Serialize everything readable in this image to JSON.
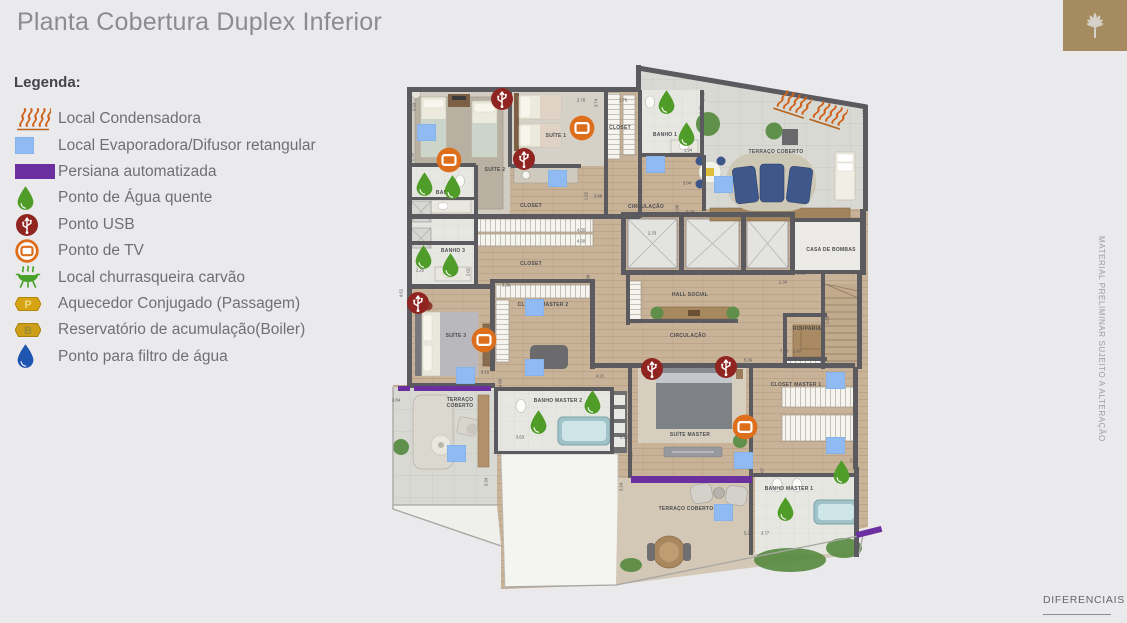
{
  "page": {
    "title": "Planta Cobertura Duplex Inferior",
    "watermark": "MATERIAL PRELIMINAR SUJEITO A ALTERAÇÃO",
    "footer_link": "DIFERENCIAIS"
  },
  "colors": {
    "background": "#eae9eb",
    "title_text": "#8b8b93",
    "logo_bg": "#a78b60",
    "condensadora_orange": "#cf6218",
    "evaporadora_blue": "#8fbbf2",
    "persiana_purple": "#6b2f9f",
    "agua_quente_green": "#4f9c28",
    "usb_red": "#8f2420",
    "tv_orange": "#dd6f1c",
    "churrasqueira_green": "#4aa22a",
    "hex_gold": "#d7a414",
    "filtro_blue": "#1d55b0",
    "wall_gray": "#5b5b5f"
  },
  "legend": {
    "title": "Legenda:",
    "items": [
      {
        "type": "cond",
        "label": "Local Condensadora"
      },
      {
        "type": "evap",
        "label": "Local Evaporadora/Difusor retangular"
      },
      {
        "type": "persiana",
        "label": "Persiana automatizada"
      },
      {
        "type": "dropg",
        "label": "Ponto de Água quente"
      },
      {
        "type": "usb",
        "label": "Ponto USB"
      },
      {
        "type": "tv",
        "label": "Ponto de TV"
      },
      {
        "type": "grill",
        "label": "Local churrasqueira carvão"
      },
      {
        "type": "hexp",
        "label": "Aquecedor Conjugado (Passagem)"
      },
      {
        "type": "hexb",
        "label": "Reservatório de acumulação(Boiler)"
      },
      {
        "type": "dropb",
        "label": "Ponto para filtro de água"
      }
    ]
  },
  "plan": {
    "labels": [
      {
        "t": "SUÍTE 2",
        "x": 107,
        "y": 113
      },
      {
        "t": "SUÍTE 1",
        "x": 168,
        "y": 79
      },
      {
        "t": "CLOSET",
        "x": 232,
        "y": 71
      },
      {
        "t": "BANHO 1",
        "x": 277,
        "y": 78
      },
      {
        "t": "BANHO 2",
        "x": 60,
        "y": 136
      },
      {
        "t": "BANHO 3",
        "x": 65,
        "y": 194
      },
      {
        "t": "CLOSET",
        "x": 143,
        "y": 149
      },
      {
        "t": "CLOSET",
        "x": 143,
        "y": 207
      },
      {
        "t": "CIRCULAÇÃO",
        "x": 258,
        "y": 150
      },
      {
        "t": "TERRAÇO COBERTO",
        "x": 388,
        "y": 95
      },
      {
        "t": "CASA DE BOMBAS",
        "x": 443,
        "y": 193
      },
      {
        "t": "HALL SOCIAL",
        "x": 302,
        "y": 238
      },
      {
        "t": "CIRCULAÇÃO",
        "x": 300,
        "y": 279
      },
      {
        "t": "ROUPARIA",
        "x": 419,
        "y": 272
      },
      {
        "t": "SUÍTE 3",
        "x": 68,
        "y": 279
      },
      {
        "t": "CLOSET MASTER 2",
        "x": 155,
        "y": 248
      },
      {
        "t": "TERRAÇO COBERTO",
        "x": 72,
        "y": 346,
        "w": 36
      },
      {
        "t": "BANHO MASTER 2",
        "x": 170,
        "y": 344
      },
      {
        "t": "SUÍTE MASTER",
        "x": 302,
        "y": 378
      },
      {
        "t": "CLOSET MASTER 1",
        "x": 408,
        "y": 328
      },
      {
        "t": "BANHO MASTER 1",
        "x": 401,
        "y": 432
      },
      {
        "t": "TERRAÇO COBERTO",
        "x": 298,
        "y": 452
      }
    ],
    "dimensions": [
      {
        "t": "3.93",
        "x": 26,
        "y": 50,
        "v": 1
      },
      {
        "t": "2.59",
        "x": 24,
        "y": 100,
        "v": 1
      },
      {
        "t": "2.25",
        "x": 32,
        "y": 213
      },
      {
        "t": "2.78",
        "x": 193,
        "y": 43
      },
      {
        "t": "3.74",
        "x": 208,
        "y": 46,
        "v": 1
      },
      {
        "t": "1.76",
        "x": 235,
        "y": 43
      },
      {
        "t": "5.46",
        "x": 315,
        "y": 40,
        "v": 1
      },
      {
        "t": "2.53",
        "x": 313,
        "y": 53,
        "v": 1
      },
      {
        "t": "1.94",
        "x": 300,
        "y": 93
      },
      {
        "t": "3.04",
        "x": 299,
        "y": 126
      },
      {
        "t": "1.06",
        "x": 289,
        "y": 152,
        "v": 1
      },
      {
        "t": "9.08",
        "x": 302,
        "y": 155
      },
      {
        "t": "4.16",
        "x": 476,
        "y": 57,
        "v": 1
      },
      {
        "t": "2.33",
        "x": 264,
        "y": 176
      },
      {
        "t": "1.92",
        "x": 198,
        "y": 139,
        "v": 1
      },
      {
        "t": "3.99",
        "x": 210,
        "y": 139
      },
      {
        "t": "4.35",
        "x": 193,
        "y": 173
      },
      {
        "t": "4.30",
        "x": 193,
        "y": 184
      },
      {
        "t": "2.02",
        "x": 80,
        "y": 215,
        "v": 1
      },
      {
        "t": "4.61",
        "x": 13,
        "y": 236,
        "v": 1
      },
      {
        "t": "3.39",
        "x": 118,
        "y": 228
      },
      {
        "t": "7.98",
        "x": 200,
        "y": 222,
        "v": 1
      },
      {
        "t": "4.05",
        "x": 112,
        "y": 326,
        "v": 1
      },
      {
        "t": "3.16",
        "x": 97,
        "y": 315
      },
      {
        "t": "4.21",
        "x": 212,
        "y": 319
      },
      {
        "t": "2.34",
        "x": 395,
        "y": 225
      },
      {
        "t": "2.55",
        "x": 413,
        "y": 216
      },
      {
        "t": "1.88",
        "x": 439,
        "y": 263,
        "v": 1
      },
      {
        "t": "7.40",
        "x": 396,
        "y": 294
      },
      {
        "t": "1.43",
        "x": 409,
        "y": 294
      },
      {
        "t": "5.36",
        "x": 360,
        "y": 303
      },
      {
        "t": "5.15",
        "x": 236,
        "y": 380
      },
      {
        "t": "4.98",
        "x": 243,
        "y": 399,
        "v": 1
      },
      {
        "t": "2.07",
        "x": 374,
        "y": 415,
        "v": 1
      },
      {
        "t": "2.94",
        "x": 466,
        "y": 403
      },
      {
        "t": "3.24",
        "x": 233,
        "y": 430,
        "v": 1
      },
      {
        "t": "3.34",
        "x": 98,
        "y": 425,
        "v": 1
      },
      {
        "t": "3.84",
        "x": 8,
        "y": 343
      },
      {
        "t": "3.63",
        "x": 132,
        "y": 380
      },
      {
        "t": "5.27",
        "x": 360,
        "y": 476
      },
      {
        "t": "3.77",
        "x": 377,
        "y": 476
      }
    ],
    "icons": [
      {
        "t": "usb",
        "x": 115,
        "y": 43
      },
      {
        "t": "usb",
        "x": 137,
        "y": 103
      },
      {
        "t": "usb",
        "x": 31,
        "y": 247
      },
      {
        "t": "usb",
        "x": 265,
        "y": 313
      },
      {
        "t": "usb",
        "x": 339,
        "y": 311
      },
      {
        "t": "tv",
        "x": 61,
        "y": 103
      },
      {
        "t": "tv",
        "x": 194,
        "y": 71
      },
      {
        "t": "tv",
        "x": 96,
        "y": 283
      },
      {
        "t": "tv",
        "x": 357,
        "y": 370
      },
      {
        "t": "evap",
        "x": 38,
        "y": 75
      },
      {
        "t": "evap",
        "x": 169,
        "y": 121
      },
      {
        "t": "evap",
        "x": 267,
        "y": 107
      },
      {
        "t": "evap",
        "x": 335,
        "y": 127
      },
      {
        "t": "evap",
        "x": 146,
        "y": 250
      },
      {
        "t": "evap",
        "x": 146,
        "y": 310
      },
      {
        "t": "evap",
        "x": 77,
        "y": 318
      },
      {
        "t": "evap",
        "x": 68,
        "y": 396
      },
      {
        "t": "evap",
        "x": 355,
        "y": 403
      },
      {
        "t": "evap",
        "x": 447,
        "y": 323
      },
      {
        "t": "evap",
        "x": 447,
        "y": 388
      },
      {
        "t": "evap",
        "x": 335,
        "y": 455
      },
      {
        "t": "dropg",
        "x": 36,
        "y": 127
      },
      {
        "t": "dropg",
        "x": 64,
        "y": 130
      },
      {
        "t": "dropg",
        "x": 35,
        "y": 200
      },
      {
        "t": "dropg",
        "x": 62,
        "y": 208
      },
      {
        "t": "dropg",
        "x": 278,
        "y": 45
      },
      {
        "t": "dropg",
        "x": 298,
        "y": 77
      },
      {
        "t": "dropg",
        "x": 150,
        "y": 365
      },
      {
        "t": "dropg",
        "x": 204,
        "y": 345
      },
      {
        "t": "dropg",
        "x": 397,
        "y": 452
      },
      {
        "t": "dropg",
        "x": 453,
        "y": 415
      },
      {
        "t": "persiana",
        "x": 16,
        "y": 331,
        "w": 12,
        "h": 5
      },
      {
        "t": "persiana",
        "x": 64,
        "y": 331,
        "w": 77,
        "h": 5
      },
      {
        "t": "persiana",
        "x": 303,
        "y": 422,
        "w": 121,
        "h": 7
      },
      {
        "t": "persiana",
        "x": 481,
        "y": 475,
        "w": 26,
        "h": 6,
        "r": -14
      },
      {
        "t": "cond",
        "x": 408,
        "y": 57,
        "r": 18
      },
      {
        "t": "cond",
        "x": 444,
        "y": 68,
        "r": 18
      }
    ]
  }
}
